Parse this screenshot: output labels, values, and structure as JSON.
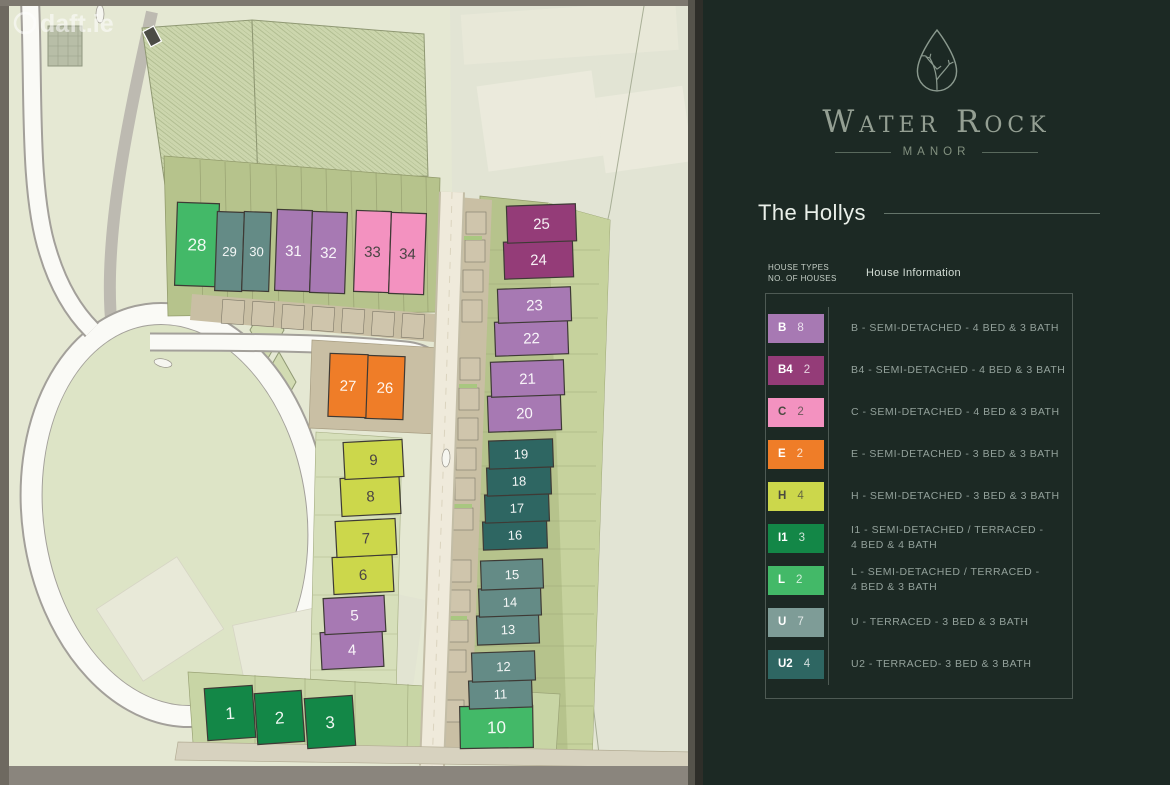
{
  "watermark": {
    "label": "daft.ie"
  },
  "brand": {
    "name": "Water Rock",
    "subtitle": "MANOR"
  },
  "panel": {
    "section_title": "The Hollys",
    "table": {
      "col1_header_line1": "HOUSE TYPES",
      "col1_header_line2": "NO. OF HOUSES",
      "col2_header": "House Information",
      "rows": [
        {
          "type": "B",
          "count": "8",
          "color": "#a779b3",
          "dark_label": false,
          "line1": "B - SEMI-DETACHED - 4 BED & 3 BATH",
          "line2": ""
        },
        {
          "type": "B4",
          "count": "2",
          "color": "#943c78",
          "dark_label": false,
          "line1": "B4 - SEMI-DETACHED - 4 BED & 3 BATH",
          "line2": ""
        },
        {
          "type": "C",
          "count": "2",
          "color": "#f392c0",
          "dark_label": true,
          "line1": "C - SEMI-DETACHED - 4 BED & 3 BATH",
          "line2": ""
        },
        {
          "type": "E",
          "count": "2",
          "color": "#ef7d28",
          "dark_label": false,
          "line1": "E - SEMI-DETACHED  - 3 BED & 3 BATH",
          "line2": ""
        },
        {
          "type": "H",
          "count": "4",
          "color": "#ccd74b",
          "dark_label": true,
          "line1": "H - SEMI-DETACHED - 3 BED & 3 BATH",
          "line2": ""
        },
        {
          "type": "I1",
          "count": "3",
          "color": "#138747",
          "dark_label": false,
          "line1": "I1 - SEMI-DETACHED / TERRACED -",
          "line2": "4 BED & 4 BATH"
        },
        {
          "type": "L",
          "count": "2",
          "color": "#43b968",
          "dark_label": false,
          "line1": "L - SEMI-DETACHED / TERRACED -",
          "line2": "4 BED & 3  BATH"
        },
        {
          "type": "U",
          "count": "7",
          "color": "#7e9c97",
          "dark_label": false,
          "map_color": "#648b86",
          "line1": "U - TERRACED - 3 BED & 3 BATH",
          "line2": ""
        },
        {
          "type": "U2",
          "count": "4",
          "color": "#2e6662",
          "dark_label": false,
          "line1": "U2 - TERRACED- 3 BED & 3 BATH",
          "line2": ""
        }
      ]
    }
  },
  "map": {
    "houses": [
      {
        "number": "1",
        "type": "I1"
      },
      {
        "number": "2",
        "type": "I1"
      },
      {
        "number": "3",
        "type": "I1"
      },
      {
        "number": "4",
        "type": "B"
      },
      {
        "number": "5",
        "type": "B"
      },
      {
        "number": "6",
        "type": "H"
      },
      {
        "number": "7",
        "type": "H"
      },
      {
        "number": "8",
        "type": "H"
      },
      {
        "number": "9",
        "type": "H"
      },
      {
        "number": "10",
        "type": "L"
      },
      {
        "number": "11",
        "type": "U"
      },
      {
        "number": "12",
        "type": "U"
      },
      {
        "number": "13",
        "type": "U"
      },
      {
        "number": "14",
        "type": "U"
      },
      {
        "number": "15",
        "type": "U"
      },
      {
        "number": "16",
        "type": "U2"
      },
      {
        "number": "17",
        "type": "U2"
      },
      {
        "number": "18",
        "type": "U2"
      },
      {
        "number": "19",
        "type": "U2"
      },
      {
        "number": "20",
        "type": "B"
      },
      {
        "number": "21",
        "type": "B"
      },
      {
        "number": "22",
        "type": "B"
      },
      {
        "number": "23",
        "type": "B"
      },
      {
        "number": "24",
        "type": "B4"
      },
      {
        "number": "25",
        "type": "B4"
      },
      {
        "number": "26",
        "type": "E"
      },
      {
        "number": "27",
        "type": "E"
      },
      {
        "number": "28",
        "type": "L"
      },
      {
        "number": "29",
        "type": "U"
      },
      {
        "number": "30",
        "type": "U"
      },
      {
        "number": "31",
        "type": "B"
      },
      {
        "number": "32",
        "type": "B"
      },
      {
        "number": "33",
        "type": "C"
      },
      {
        "number": "34",
        "type": "C"
      }
    ]
  }
}
